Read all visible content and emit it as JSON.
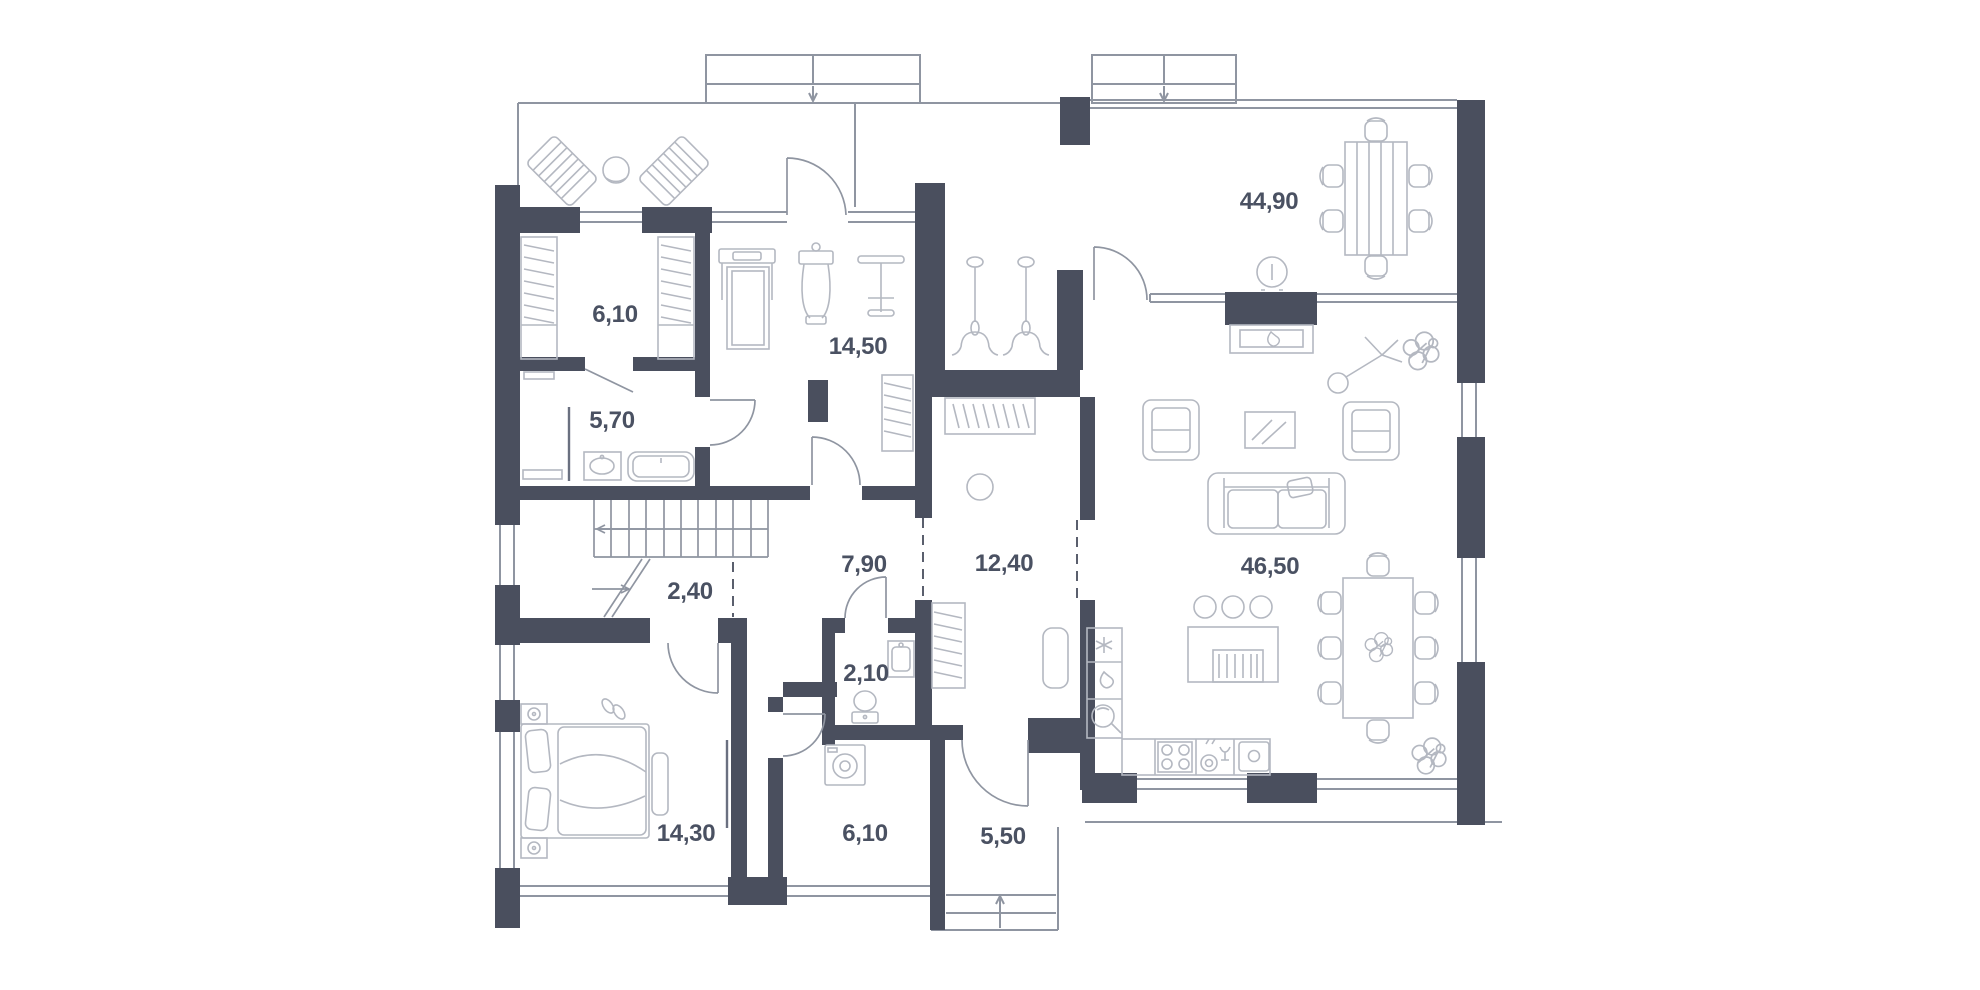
{
  "plan": {
    "type": "residential-floor-plan",
    "background": "#ffffff",
    "wall_color": "#4a4f5e",
    "structure_line_color": "#8f95a1",
    "furniture_line_color": "#b4b8c1",
    "label_color": "#4a5162",
    "rooms": [
      {
        "id": "wardrobe-upper",
        "area_label": "6,10"
      },
      {
        "id": "bathroom-upper",
        "area_label": "5,70"
      },
      {
        "id": "gym",
        "area_label": "14,50"
      },
      {
        "id": "stair-hall",
        "area_label": "2,40"
      },
      {
        "id": "hallway",
        "area_label": "7,90"
      },
      {
        "id": "corridor",
        "area_label": "12,40"
      },
      {
        "id": "wc",
        "area_label": "2,10"
      },
      {
        "id": "living-dining",
        "area_label": "44,90"
      },
      {
        "id": "kitchen-living",
        "area_label": "46,50"
      },
      {
        "id": "bedroom",
        "area_label": "14,30"
      },
      {
        "id": "bathroom-lower",
        "area_label": "6,10"
      },
      {
        "id": "entryway",
        "area_label": "5,50"
      }
    ],
    "furniture_icons": [
      "sun-lounger-icon",
      "terrace-table-icon",
      "wardrobe-icon",
      "washbasin-icon",
      "bathtub-icon",
      "treadmill-icon",
      "exercise-machine-icon",
      "weight-station-icon",
      "spin-bike-icon",
      "staircase-icon",
      "coat-rack-icon",
      "pouf-icon",
      "bench-icon",
      "toilet-icon",
      "vanity-sink-icon",
      "washing-machine-icon",
      "double-bed-icon",
      "nightstand-icon",
      "tv-icon",
      "fireplace-icon",
      "round-table-icon",
      "dining-table-6-icon",
      "dining-table-8-icon",
      "sofa-icon",
      "armchair-icon",
      "coffee-table-icon",
      "kitchen-island-icon",
      "bar-stool-icon",
      "refrigerator-icon",
      "oven-icon",
      "cooktop-icon",
      "dishwasher-icon",
      "kitchen-sink-icon",
      "floor-lamp-icon",
      "plant-icon",
      "entry-steps-icon"
    ]
  }
}
